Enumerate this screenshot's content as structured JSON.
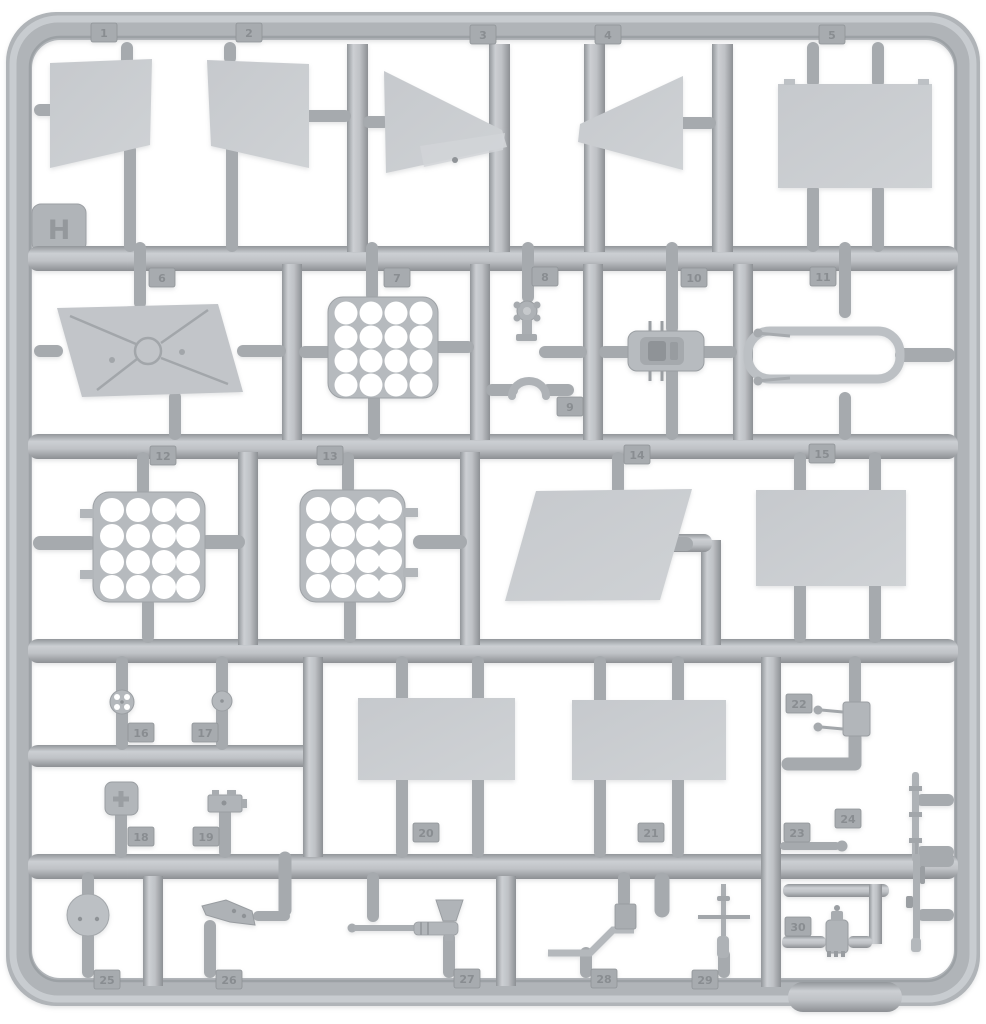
{
  "sprue": {
    "letter_tag": "H",
    "part_tags": [
      "1",
      "2",
      "3",
      "4",
      "5",
      "6",
      "7",
      "8",
      "9",
      "10",
      "11",
      "12",
      "13",
      "14",
      "15",
      "16",
      "17",
      "18",
      "19",
      "20",
      "21",
      "22",
      "23",
      "24",
      "25",
      "26",
      "27",
      "28",
      "29",
      "30"
    ],
    "colors": {
      "background": "#ffffff",
      "plastic": "#b4b8bc",
      "plastic_highlight": "#d3d6d9",
      "plastic_shadow": "#8f9397",
      "flat_panel": "#c9ccd0",
      "tag_block": "#a7abaf"
    },
    "parts": [
      {
        "tag": "1",
        "shape": "angled flap panel"
      },
      {
        "tag": "2",
        "shape": "angled flap panel, mirrored"
      },
      {
        "tag": "3",
        "shape": "tapered wedge panel, tip right"
      },
      {
        "tag": "4",
        "shape": "tapered wedge panel, tip left"
      },
      {
        "tag": "5",
        "shape": "rectangular plate with top nubs"
      },
      {
        "tag": "6",
        "shape": "parallelogram hatch with X brace and central ring"
      },
      {
        "tag": "7",
        "shape": "perforated plate, 4x4 round holes"
      },
      {
        "tag": "8",
        "shape": "small pump cap"
      },
      {
        "tag": "9",
        "shape": "small arched clamp"
      },
      {
        "tag": "10",
        "shape": "small detailed box"
      },
      {
        "tag": "11",
        "shape": "tubular frame loop with thin rods"
      },
      {
        "tag": "12",
        "shape": "perforated plate, 4x4 round holes"
      },
      {
        "tag": "13",
        "shape": "perforated plate, 4x4 round holes, side tabs"
      },
      {
        "tag": "14",
        "shape": "large slanted trapezoid panel"
      },
      {
        "tag": "15",
        "shape": "large rectangular panel"
      },
      {
        "tag": "16",
        "shape": "small wheel with four holes"
      },
      {
        "tag": "17",
        "shape": "small disc"
      },
      {
        "tag": "18",
        "shape": "square pad with embossed cross"
      },
      {
        "tag": "19",
        "shape": "small bracket box"
      },
      {
        "tag": "20",
        "shape": "rectangular panel"
      },
      {
        "tag": "21",
        "shape": "rectangular panel"
      },
      {
        "tag": "22",
        "shape": "bracket plate with two pins"
      },
      {
        "tag": "23",
        "shape": "small pin with ball end"
      },
      {
        "tag": "24",
        "shape": "thin rod with collars"
      },
      {
        "tag": "25",
        "shape": "round lid with two holes"
      },
      {
        "tag": "26",
        "shape": "lever handle"
      },
      {
        "tag": "27",
        "shape": "barrel with funnel top"
      },
      {
        "tag": "28",
        "shape": "bent flat strip with mount block"
      },
      {
        "tag": "29",
        "shape": "rod with crossbar"
      },
      {
        "tag": "30",
        "shape": "small valve body"
      }
    ]
  }
}
